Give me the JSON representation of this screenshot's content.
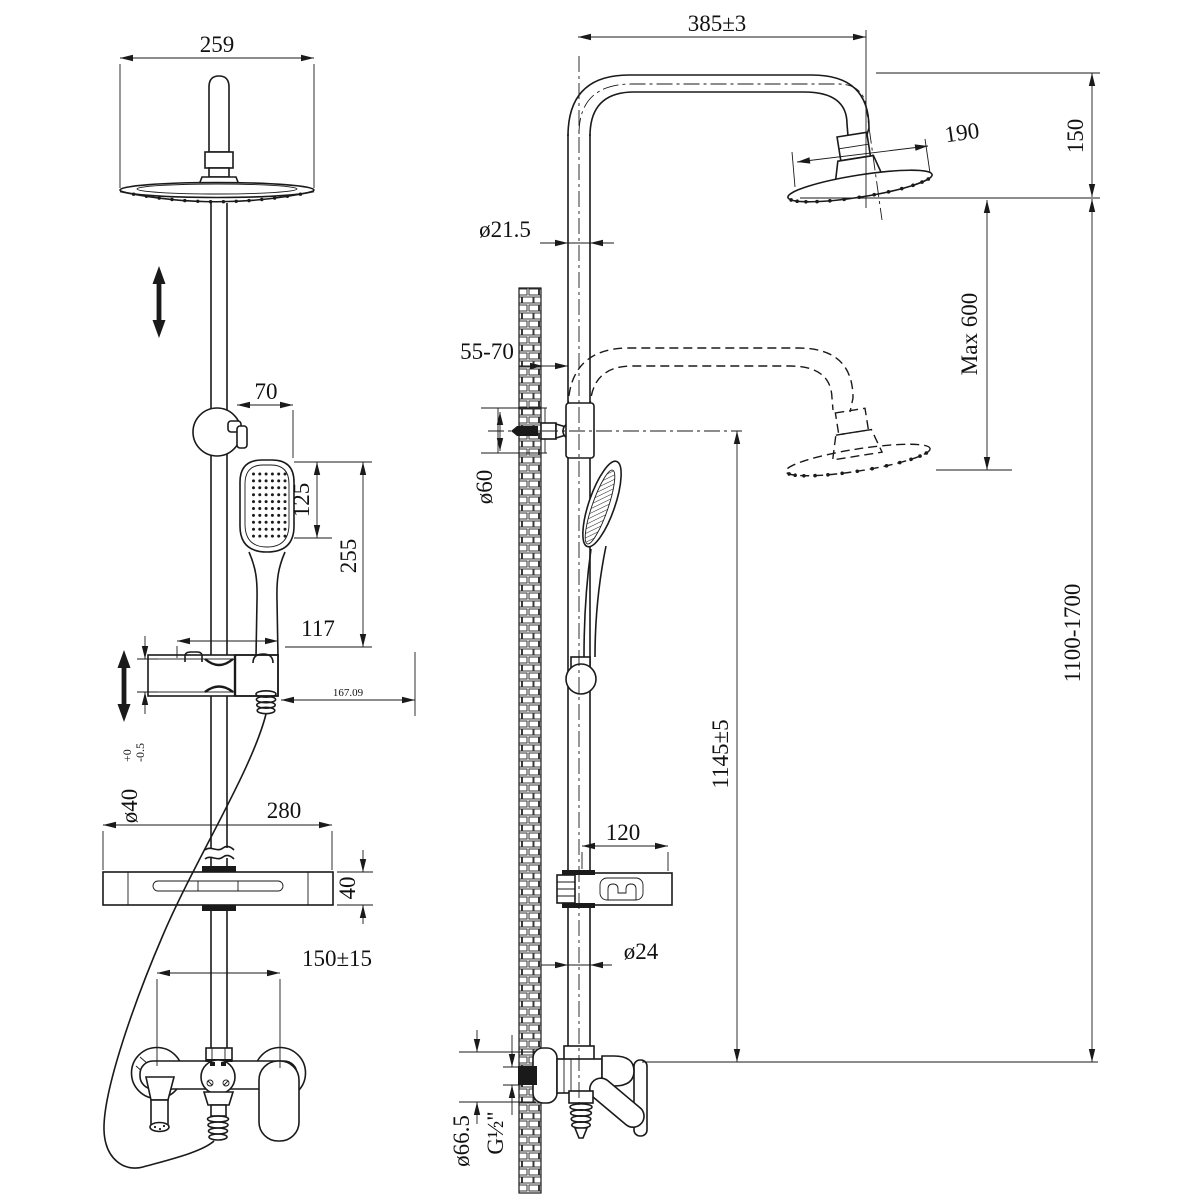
{
  "title": "Shower column technical drawing, front and side views",
  "colors": {
    "line": "#1a1a1a",
    "background": "#ffffff"
  },
  "dimensions": {
    "head_width": "259",
    "arm_length": "385±3",
    "head_diameter": "190",
    "head_drop": "150",
    "max_adjust": "Max 600",
    "pipe_diameter": "ø21.5",
    "wall_clearance": "55-70",
    "bracket_diameter": "ø60",
    "holder_offset": "70",
    "handshower_face": "125",
    "handshower_length": "255",
    "slider_width": "117",
    "slider_depth": "167.09",
    "riser_diameter": "ø40",
    "riser_tol_upper": "+0",
    "riser_tol_lower": "-0.5",
    "shelf_width": "280",
    "shelf_height": "40",
    "inlet_spacing": "150±15",
    "handshower_height": "1145±5",
    "total_height": "1100-1700",
    "hook_width": "120",
    "lower_pipe_diameter": "ø24",
    "escutcheon_diameter": "ø66.5",
    "thread_size": "G½\""
  }
}
